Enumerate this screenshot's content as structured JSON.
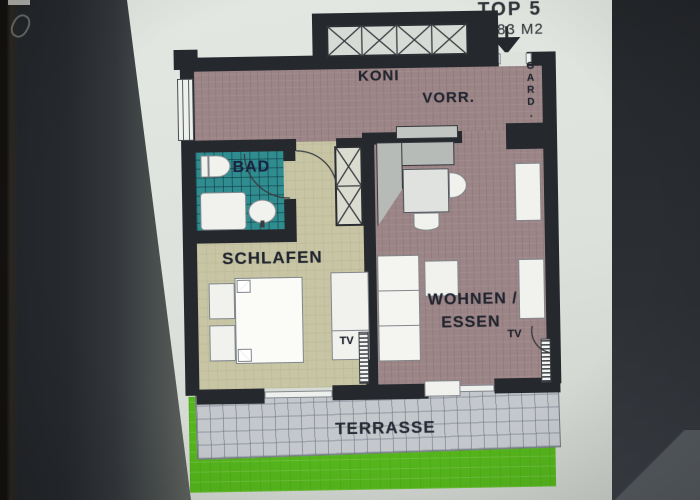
{
  "plan": {
    "unit": {
      "title": "TOP 5",
      "area": "49,83 M2"
    },
    "rooms": {
      "hall": {
        "label_a": "KONI",
        "label_b": "VORR."
      },
      "gard": {
        "label": "GARD."
      },
      "bath": {
        "label": "BAD"
      },
      "bedroom": {
        "label": "SCHLAFEN",
        "tv_label": "TV"
      },
      "living": {
        "label_line1": "WOHNEN /",
        "label_line2": "ESSEN",
        "tv_label": "TV"
      },
      "terrace": {
        "label": "TERRASSE"
      }
    },
    "colors": {
      "wall": "#25282d",
      "hall_floor": "#9c8587",
      "bedroom_floor": "#c7c5a4",
      "bath_floor": "#2f8d90",
      "terrace_floor": "#c4c8cd",
      "lawn": "#55b61c",
      "page": "#dee2dc"
    },
    "icons": {
      "entrance_arrow": "filled-down-triangle"
    }
  }
}
